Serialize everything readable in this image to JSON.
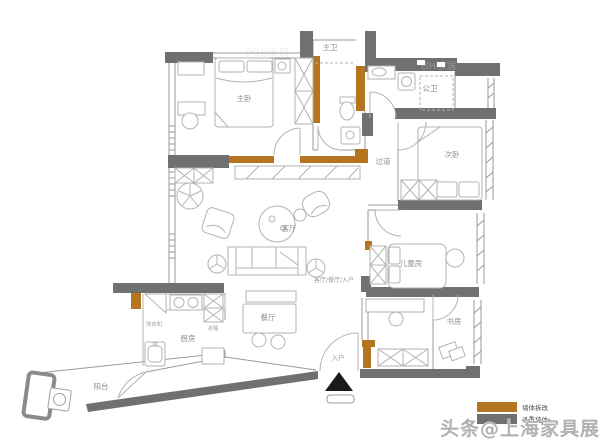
{
  "floorplan": {
    "rooms": [
      {
        "id": "master-bedroom",
        "label": "主卧"
      },
      {
        "id": "master-bathroom",
        "label": "主卫"
      },
      {
        "id": "public-bathroom",
        "label": "公卫"
      },
      {
        "id": "corridor",
        "label": "过道"
      },
      {
        "id": "second-bedroom",
        "label": "次卧"
      },
      {
        "id": "kids-room",
        "label": "儿童房"
      },
      {
        "id": "study",
        "label": "书房"
      },
      {
        "id": "living-room",
        "label": "客厅"
      },
      {
        "id": "dining-room",
        "label": "餐厅"
      },
      {
        "id": "kitchen",
        "label": "厨房"
      },
      {
        "id": "balcony",
        "label": "阳台"
      }
    ],
    "annotations": [
      {
        "id": "zone-label",
        "label": "客厅/餐厅/入户"
      },
      {
        "id": "entry",
        "label": "入户"
      },
      {
        "id": "washing-machine",
        "label": "洗衣机"
      },
      {
        "id": "fridge",
        "label": "冰箱"
      }
    ],
    "legend": {
      "items": [
        {
          "label": "墙体拆改",
          "color": "#b5741f"
        },
        {
          "label": "承重墙体",
          "color": "#707070"
        }
      ]
    },
    "watermark": "头条@上海家具展",
    "faint_watermark": "创HI家居",
    "colors": {
      "load_bearing_wall": "#707070",
      "modified_wall": "#b5741f",
      "thin_wall": "#9a9a9a",
      "furniture": "#b3b3b3",
      "label_text": "#8f8f8f"
    }
  }
}
